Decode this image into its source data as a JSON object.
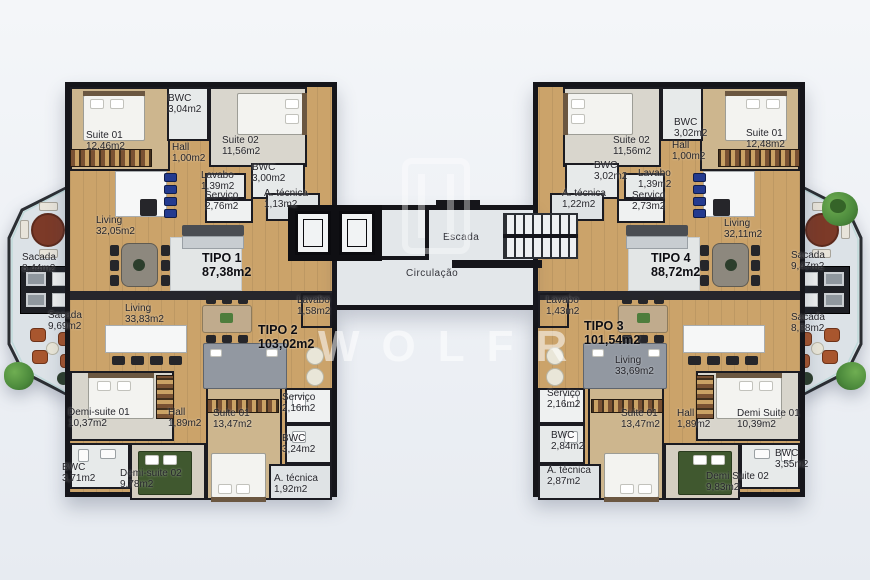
{
  "title": "Planta do pavimento - apartamentos TIPO 1 a TIPO 4",
  "watermark": {
    "text": "WOLFR"
  },
  "core": {
    "escada": "Escada",
    "circulacao": "Circulação"
  },
  "colors": {
    "background": "#e9edf2",
    "wall": "#17171c",
    "wood_floor": "#cba36a",
    "tile": "#e7eaea",
    "balcony": "#dce2e7",
    "slab": "#26262c",
    "balcony_table": "#7c3a28",
    "lounge_chair": "#a8562e",
    "greenery": "#4c8a3c",
    "bar_stool_blue": "#233a8f",
    "bed_green": "#40582f",
    "watermark": "#ffffff"
  },
  "labels": {
    "t1": {
      "unit": {
        "n": "TIPO 1",
        "a": "87,38m2"
      },
      "suite01": {
        "n": "Suite 01",
        "a": "12,46m2"
      },
      "bwc_a": {
        "n": "BWC",
        "a": "3,04m2"
      },
      "suite02": {
        "n": "Suite 02",
        "a": "11,56m2"
      },
      "hall": {
        "n": "Hall",
        "a": "1,00m2"
      },
      "lavabo": {
        "n": "Lavabo",
        "a": "1,39m2"
      },
      "bwc_b": {
        "n": "BWC",
        "a": "3,00m2"
      },
      "servico": {
        "n": "Serviço",
        "a": "2,76m2"
      },
      "atecnica": {
        "n": "A. técnica",
        "a": "1,13m2"
      },
      "living": {
        "n": "Living",
        "a": "32,05m2"
      },
      "sacada": {
        "n": "Sacada",
        "a": "8,44m2"
      }
    },
    "t2": {
      "unit": {
        "n": "TIPO 2",
        "a": "103,02m2"
      },
      "sacada": {
        "n": "Sacada",
        "a": "9,69m2"
      },
      "living": {
        "n": "Living",
        "a": "33,83m2"
      },
      "lavabo": {
        "n": "Lavabo",
        "a": "1,58m2"
      },
      "demisuite01": {
        "n": "Demi-suite 01",
        "a": "10,37m2"
      },
      "hall": {
        "n": "Hall",
        "a": "1,89m2"
      },
      "suite01": {
        "n": "Suite 01",
        "a": "13,47m2"
      },
      "servico": {
        "n": "Serviço",
        "a": "2,16m2"
      },
      "bwc_a": {
        "n": "BWC",
        "a": "3,24m2"
      },
      "bwc_b": {
        "n": "BWC",
        "a": "3,71m2"
      },
      "demisuite02": {
        "n": "Demi-suite 02",
        "a": "9,78m2"
      },
      "atecnica": {
        "n": "A. técnica",
        "a": "1,92m2"
      }
    },
    "t4": {
      "unit": {
        "n": "TIPO 4",
        "a": "88,72m2"
      },
      "suite02": {
        "n": "Suite 02",
        "a": "11,56m2"
      },
      "bwc_a": {
        "n": "BWC",
        "a": "3,02m2"
      },
      "suite01": {
        "n": "Suite 01",
        "a": "12,48m2"
      },
      "hall": {
        "n": "Hall",
        "a": "1,00m2"
      },
      "bwc_b": {
        "n": "BWC",
        "a": "3,02m2"
      },
      "lavabo": {
        "n": "Lavabo",
        "a": "1,39m2"
      },
      "atecnica": {
        "n": "A. técnica",
        "a": "1,22m2"
      },
      "servico": {
        "n": "Serviço",
        "a": "2,73m2"
      },
      "living": {
        "n": "Living",
        "a": "32,11m2"
      },
      "sacada": {
        "n": "Sacada",
        "a": "9,47m2"
      }
    },
    "t3": {
      "unit": {
        "n": "TIPO 3",
        "a": "101,54m2"
      },
      "lavabo": {
        "n": "Lavabo",
        "a": "1,43m2"
      },
      "living": {
        "n": "Living",
        "a": "33,69m2"
      },
      "servico": {
        "n": "Serviço",
        "a": "2,16m2"
      },
      "suite01": {
        "n": "Suite 01",
        "a": "13,47m2"
      },
      "hall": {
        "n": "Hall",
        "a": "1,89m2"
      },
      "demisuite01": {
        "n": "Demi Suite 01",
        "a": "10,39m2"
      },
      "bwc_a": {
        "n": "BWC",
        "a": "2,84m2"
      },
      "atecnica": {
        "n": "A. técnica",
        "a": "2,87m2"
      },
      "demisuite02": {
        "n": "Demi Suite 02",
        "a": "9,83m2"
      },
      "bwc_b": {
        "n": "BWC",
        "a": "3,55m2"
      },
      "sacada": {
        "n": "Sacada",
        "a": "8,58m2"
      }
    }
  }
}
